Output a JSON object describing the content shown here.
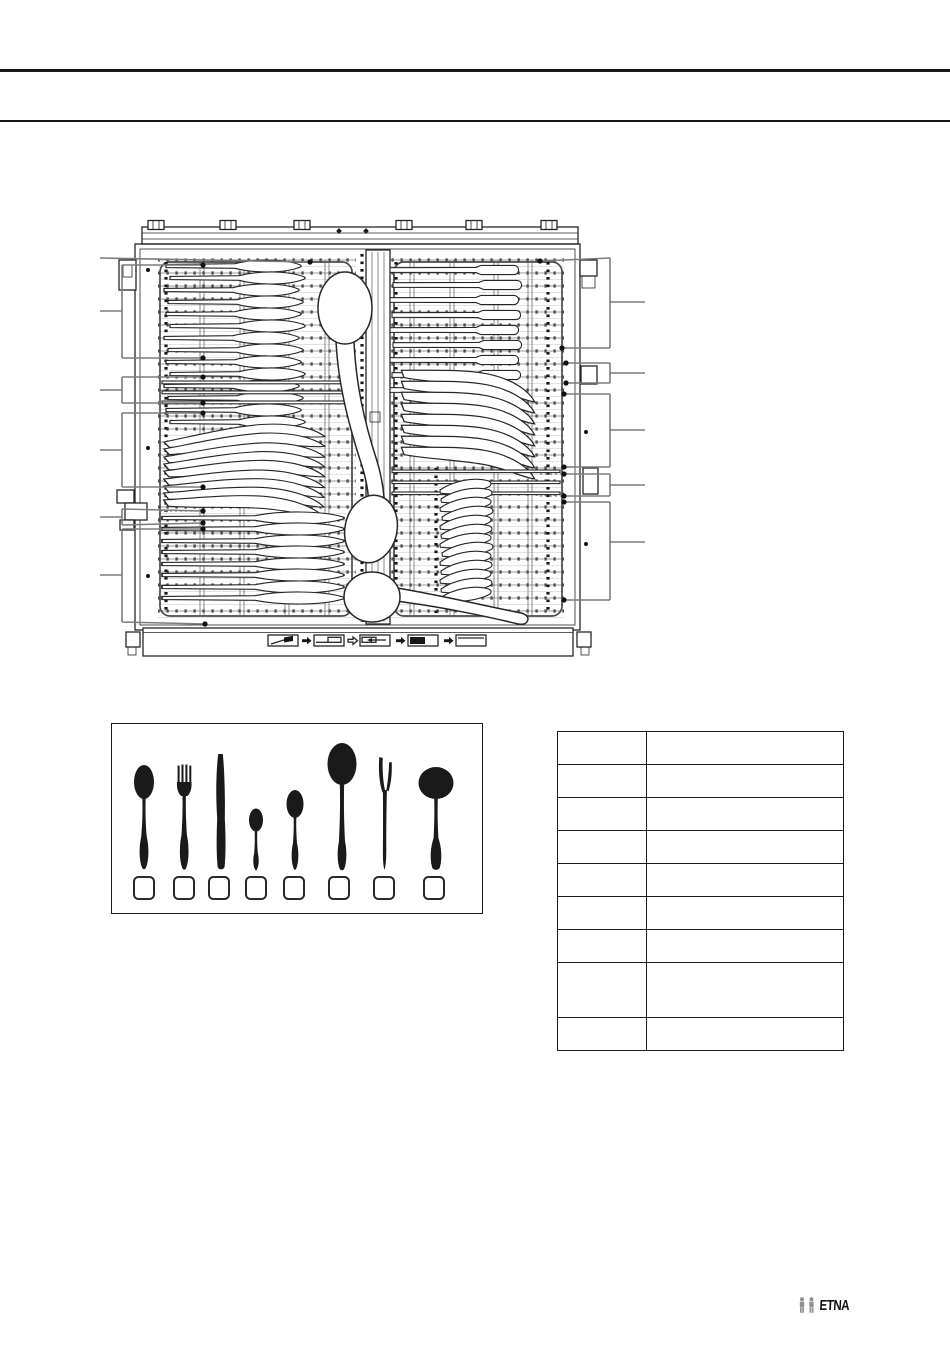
{
  "page": {
    "kind": "appliance-manual-scanned-page",
    "background": "#ffffff",
    "rule_color": "#161616"
  },
  "diagram": {
    "subject": "dishwasher-cutlery-drawer-top-view",
    "description_visible_text": "",
    "callouts_left_count": 6,
    "callouts_right_count": 5,
    "front_panel_icon_count": 5
  },
  "legend": {
    "items": [
      {
        "icon": "table-spoon-icon",
        "checkbox_value": ""
      },
      {
        "icon": "table-fork-icon",
        "checkbox_value": ""
      },
      {
        "icon": "table-knife-icon",
        "checkbox_value": ""
      },
      {
        "icon": "teaspoon-icon",
        "checkbox_value": ""
      },
      {
        "icon": "dessert-spoon-icon",
        "checkbox_value": ""
      },
      {
        "icon": "serving-spoon-icon",
        "checkbox_value": ""
      },
      {
        "icon": "serving-fork-icon",
        "checkbox_value": ""
      },
      {
        "icon": "ladle-icon",
        "checkbox_value": ""
      }
    ]
  },
  "table": {
    "column_count": 2,
    "rows": [
      {
        "cells": [
          "",
          ""
        ]
      },
      {
        "cells": [
          "",
          ""
        ]
      },
      {
        "cells": [
          "",
          ""
        ]
      },
      {
        "cells": [
          "",
          ""
        ]
      },
      {
        "cells": [
          "",
          ""
        ]
      },
      {
        "cells": [
          "",
          ""
        ]
      },
      {
        "cells": [
          "",
          ""
        ]
      },
      {
        "cells": [
          "",
          ""
        ]
      },
      {
        "cells": [
          "",
          ""
        ]
      }
    ]
  },
  "brand": {
    "logo_text": "ETNA"
  }
}
